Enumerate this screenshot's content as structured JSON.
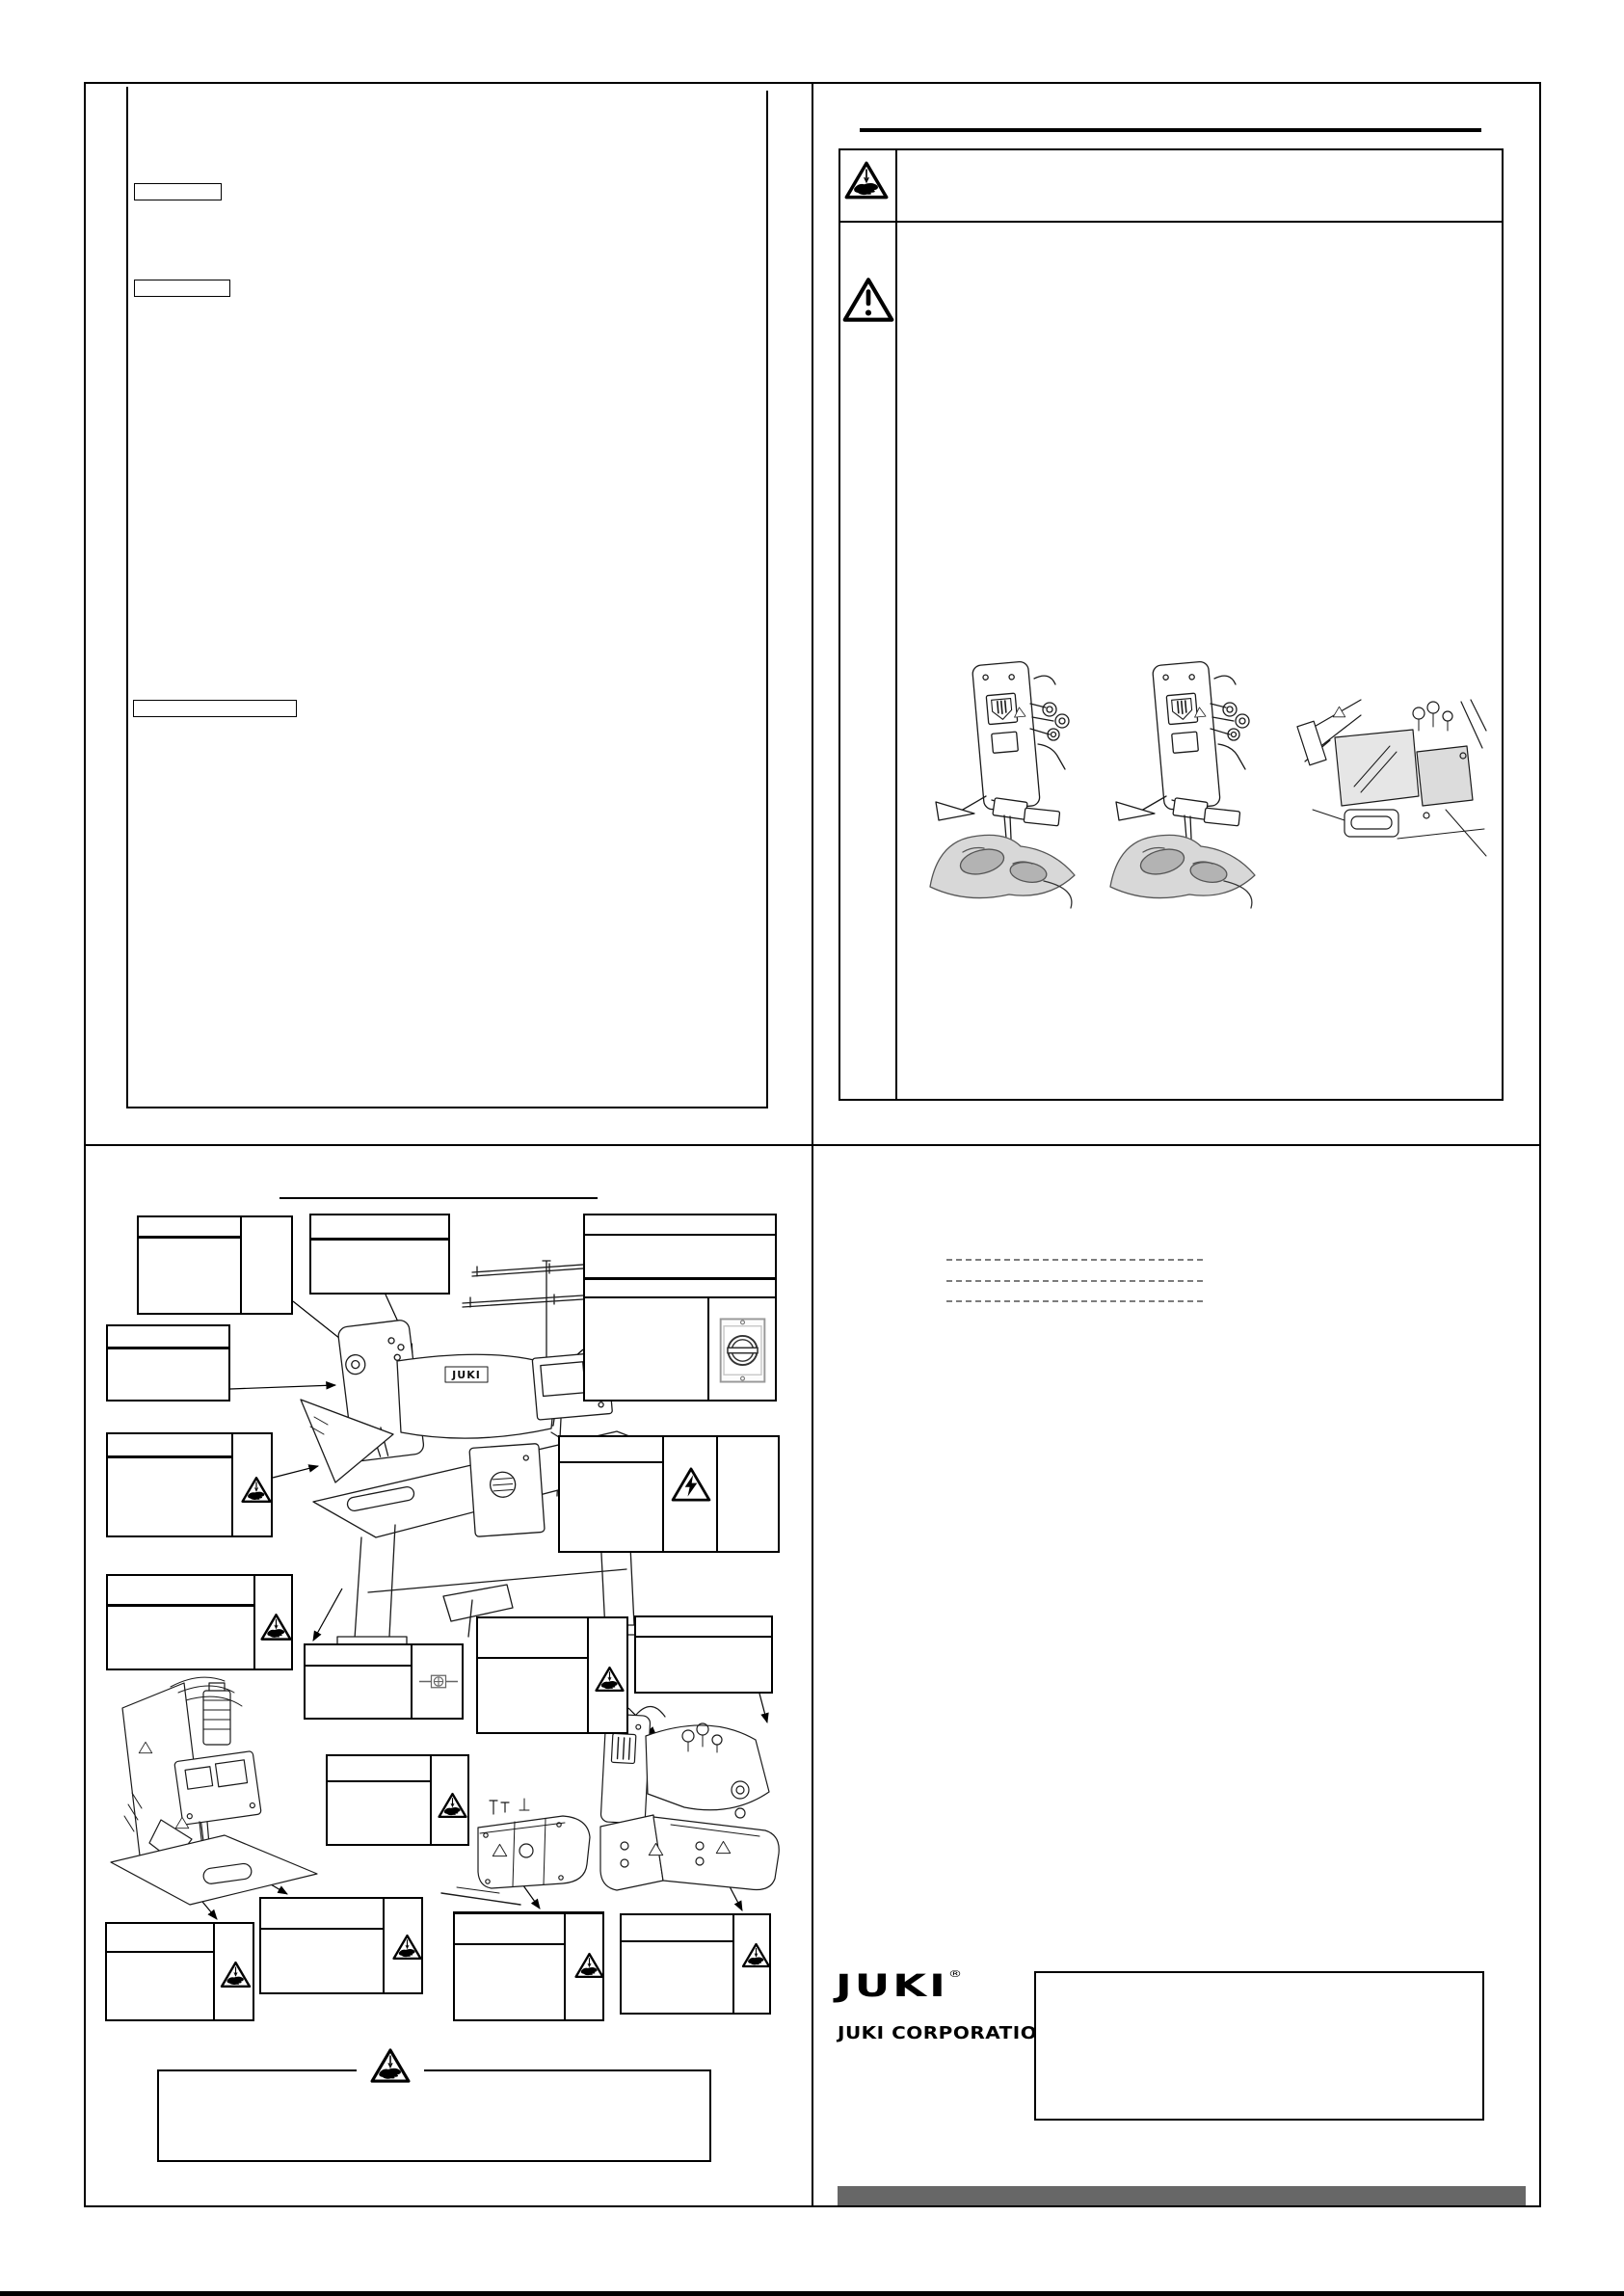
{
  "branding": {
    "logo_text": "JUKI",
    "registered_mark": "®",
    "company_name": "JUKI CORPORATION"
  },
  "labels": {
    "machine_brand": "JUKI"
  },
  "colors": {
    "ink": "#000000",
    "paper": "#ffffff",
    "footer_bar": "#676767",
    "dashed_line": "#7c7c7c",
    "ground_symbol": "#666666"
  },
  "icons": {
    "warning_hand_icon": "triangle with needle and hand (pinch/needle injury)",
    "warning_general_icon": "triangle with exclamation mark",
    "warning_electric_icon": "triangle with lightning bolt (electric shock)",
    "ground_icon": "protective earth / grounding symbol",
    "power_switch_icon": "rotary main power switch",
    "plain_triangle_icon": "small blank warning triangle label"
  },
  "structure": {
    "quadrants": [
      "instruction-text-page",
      "safety-warning-page",
      "warning-label-location-page",
      "back-cover-page"
    ],
    "warning_table_rows": 2,
    "illustration_count_safety_page": 3,
    "callout_box_count": 16
  }
}
